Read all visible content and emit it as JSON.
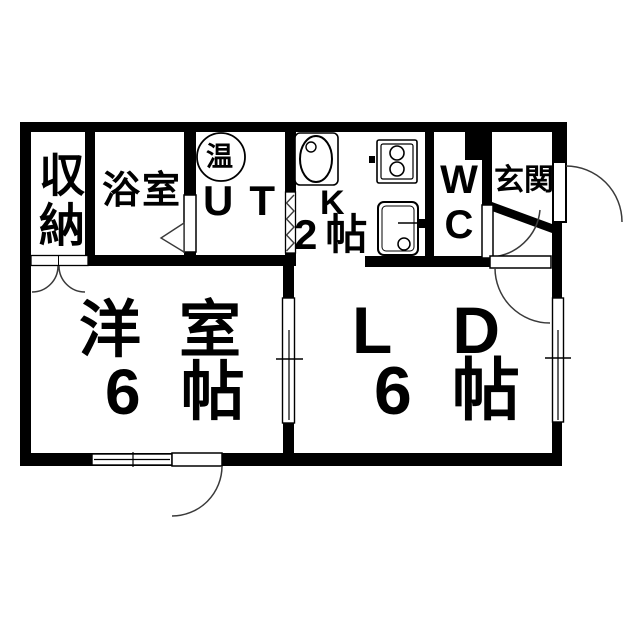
{
  "floorplan": {
    "rooms": {
      "storage": {
        "label": "収納"
      },
      "bathroom": {
        "label": "浴室"
      },
      "water_heater": {
        "label": "温"
      },
      "utility": {
        "label": "UT"
      },
      "kitchen": {
        "label": "K",
        "size": "2帖"
      },
      "toilet": {
        "label": "WC"
      },
      "entrance": {
        "label": "玄関"
      },
      "western_room": {
        "label": "洋室",
        "size": "6帖"
      },
      "living_dining": {
        "label": "LD",
        "size": "6帖"
      }
    },
    "colors": {
      "wall": "#000000",
      "door_line": "#3a3a3a",
      "background": "#ffffff"
    }
  }
}
